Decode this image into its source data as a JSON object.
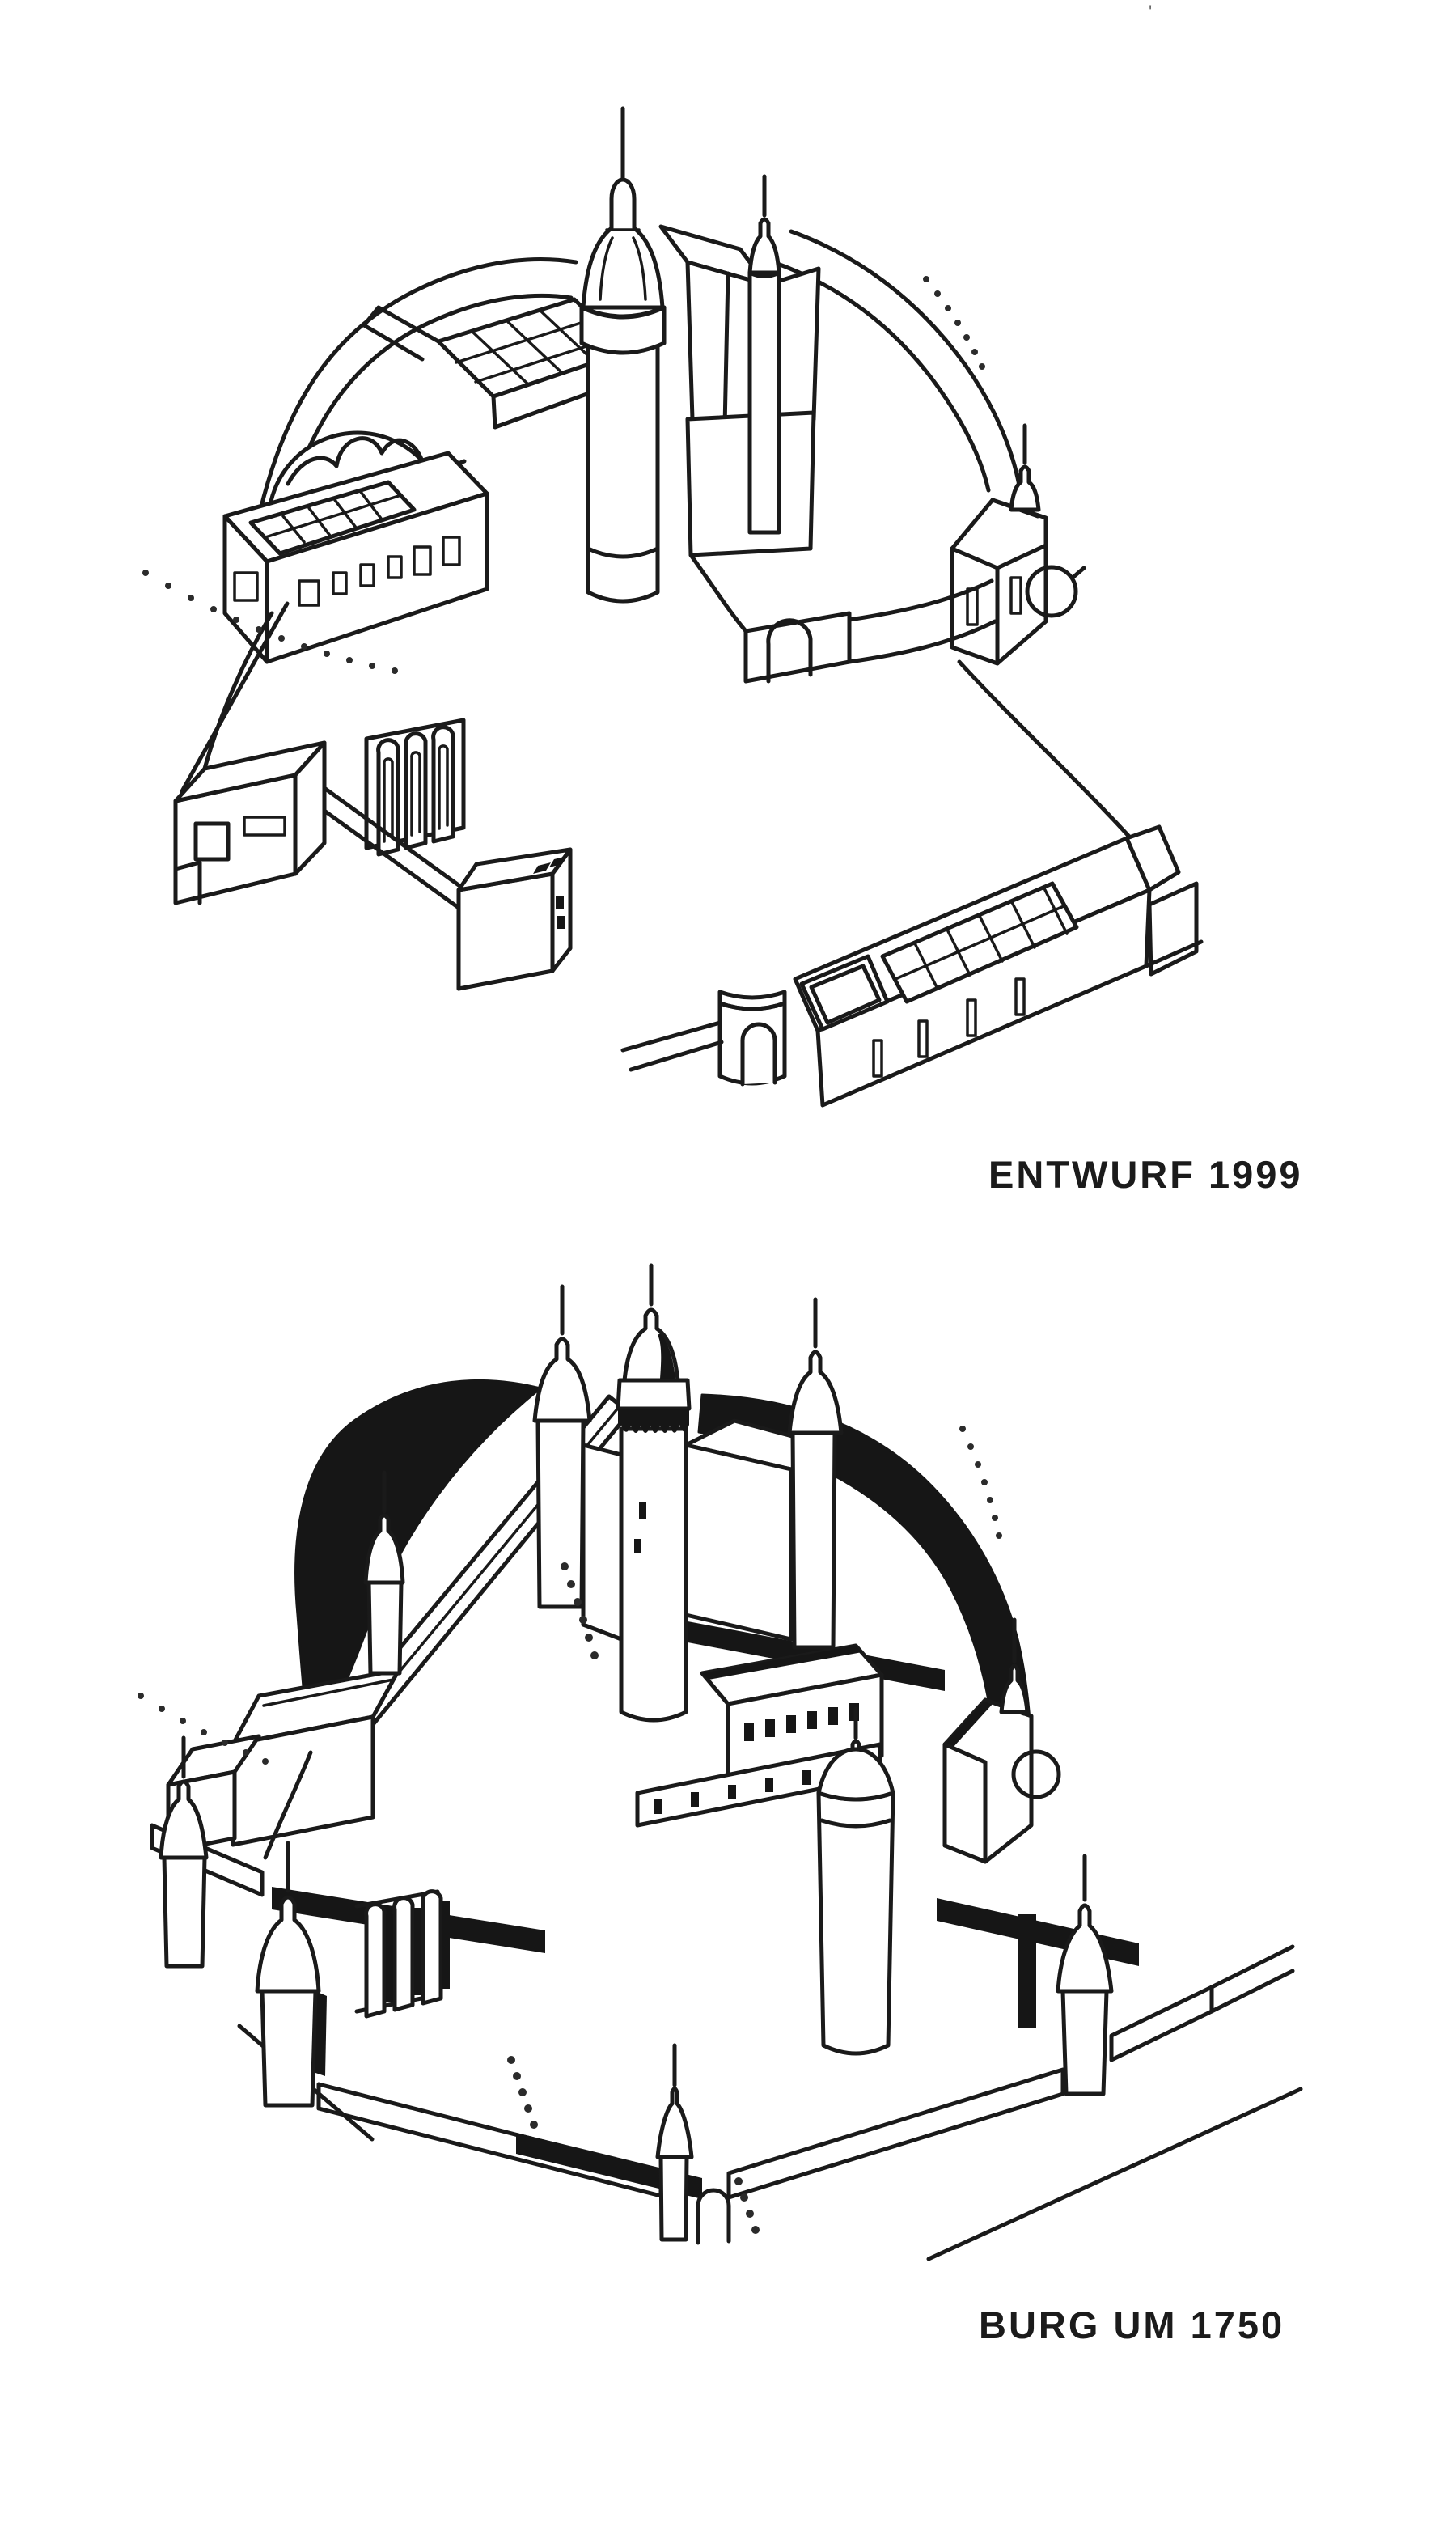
{
  "page": {
    "background_color": "#ffffff",
    "ink_color": "#1a1a1a",
    "scan_mark": "'"
  },
  "figures": [
    {
      "id": "entwurf-1999",
      "caption": "ENTWURF 1999"
    },
    {
      "id": "burg-um-1750",
      "caption": "BURG UM 1750"
    }
  ]
}
